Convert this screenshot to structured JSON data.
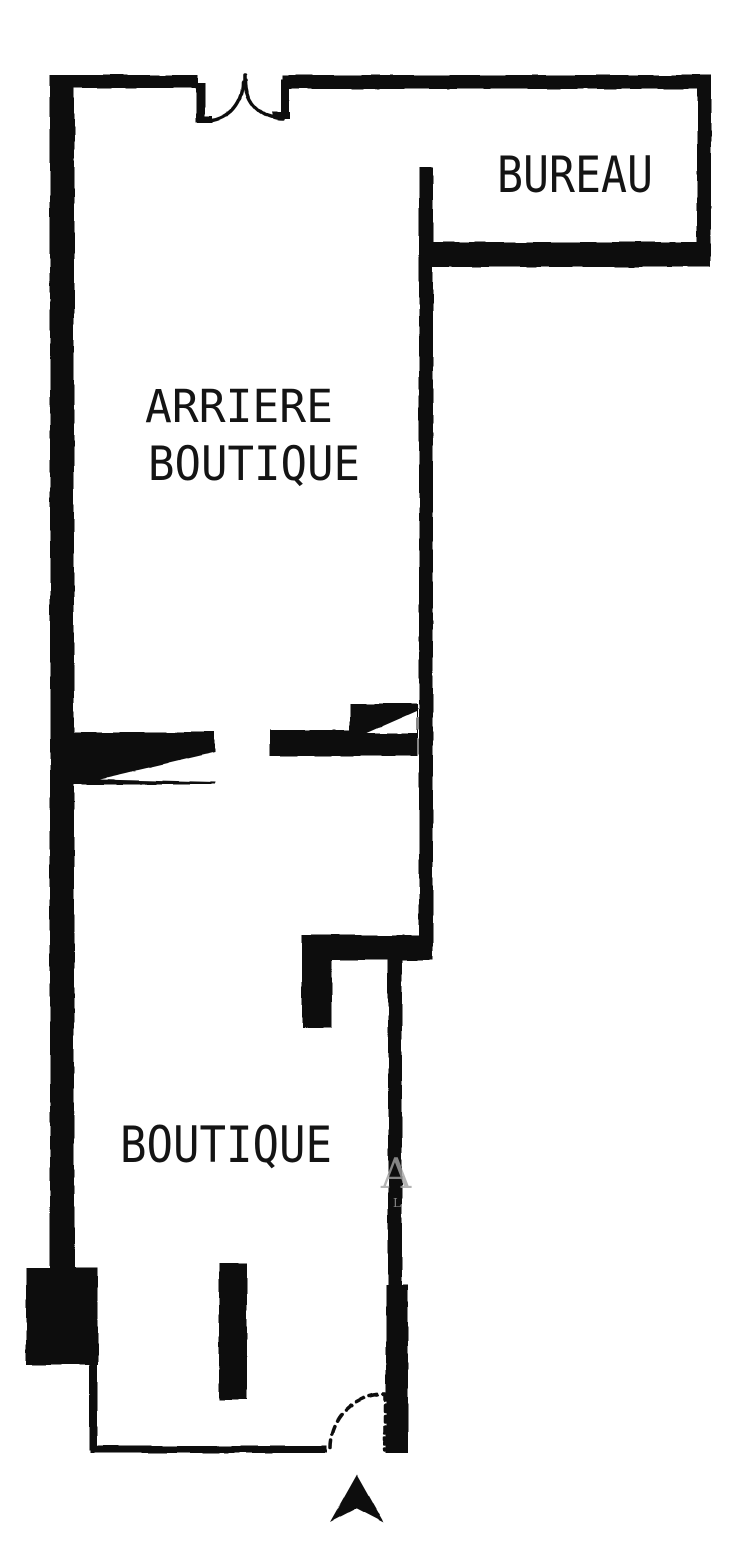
{
  "page": {
    "type": "architectural floor plan (scanned)",
    "background": "#ffffff"
  },
  "colors": {
    "wall": "#0d0d0d",
    "text": "#141414",
    "background": "#ffffff",
    "watermark": "#a2a2a2"
  },
  "rooms": [
    {
      "id": "bureau",
      "label": "BUREAU"
    },
    {
      "id": "arriere-boutique",
      "label_lines": [
        "ARRIERE",
        "BOUTIQUE"
      ]
    },
    {
      "id": "boutique",
      "label": "BOUTIQUE"
    }
  ],
  "doors": [
    {
      "id": "double-door-top",
      "type": "double-swing"
    },
    {
      "id": "passage-back-left",
      "type": "wedge-leaf"
    },
    {
      "id": "passage-back-right",
      "type": "wedge-leaf"
    },
    {
      "id": "entry-door-front",
      "type": "single-swing"
    }
  ],
  "compass": {
    "icon": "north-arrow",
    "points_to": "north"
  },
  "watermark": {
    "letters": [
      "A",
      "L"
    ]
  }
}
